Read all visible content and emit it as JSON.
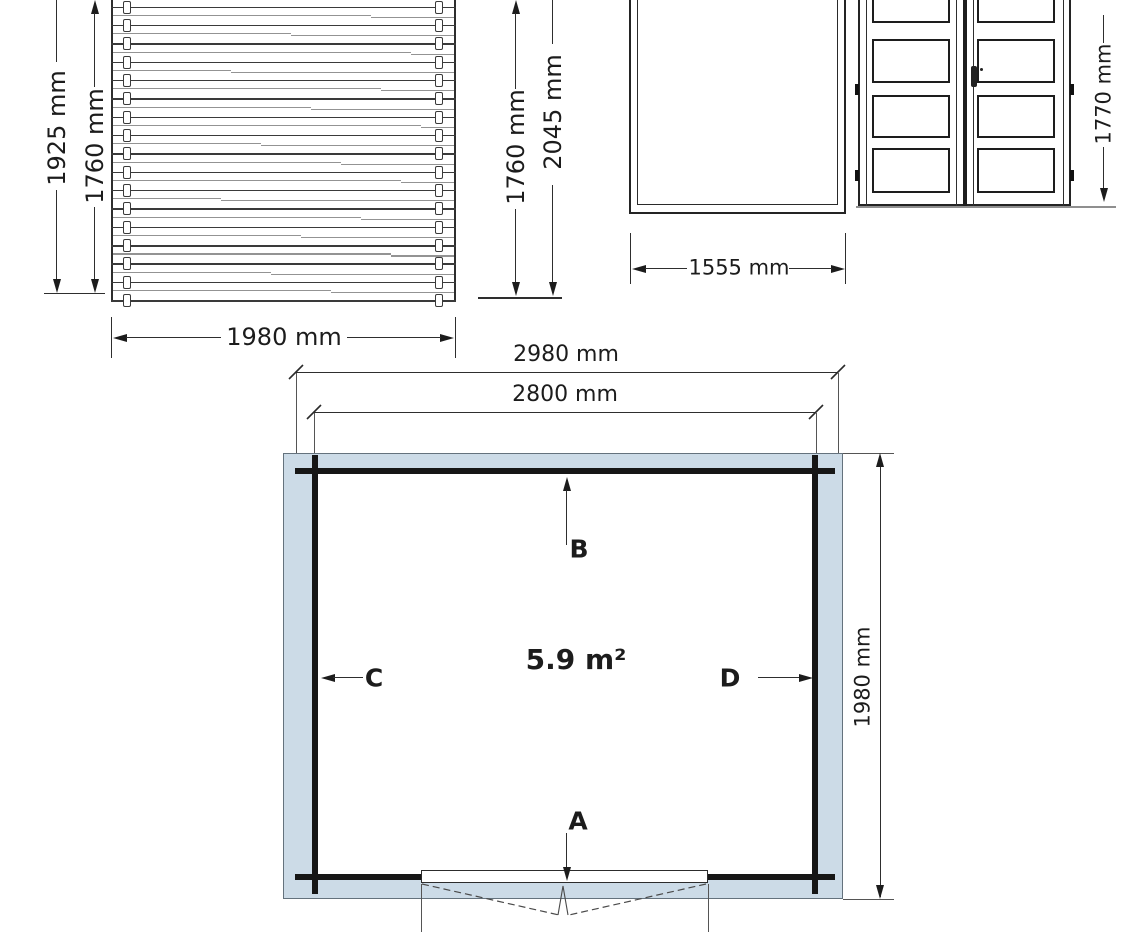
{
  "drawing": {
    "colors": {
      "wall_fill": "#ccdbe7",
      "line": "#1c1c1c"
    },
    "side_wall": {
      "dim_total_height": "1925 mm",
      "dim_wall_height": "1760 mm",
      "dim_width": "1980 mm"
    },
    "middle_heights": {
      "dim_wall_height": "1760 mm",
      "dim_ridge_height": "2045 mm"
    },
    "frame": {
      "dim_width": "1555 mm"
    },
    "doors": {
      "dim_height": "1770 mm"
    },
    "floor_plan": {
      "dim_outer_width": "2980 mm",
      "dim_inner_width": "2800 mm",
      "dim_depth": "1980 mm",
      "area": "5.9 m²",
      "marker_a": "A",
      "marker_b": "B",
      "marker_c": "C",
      "marker_d": "D"
    }
  }
}
